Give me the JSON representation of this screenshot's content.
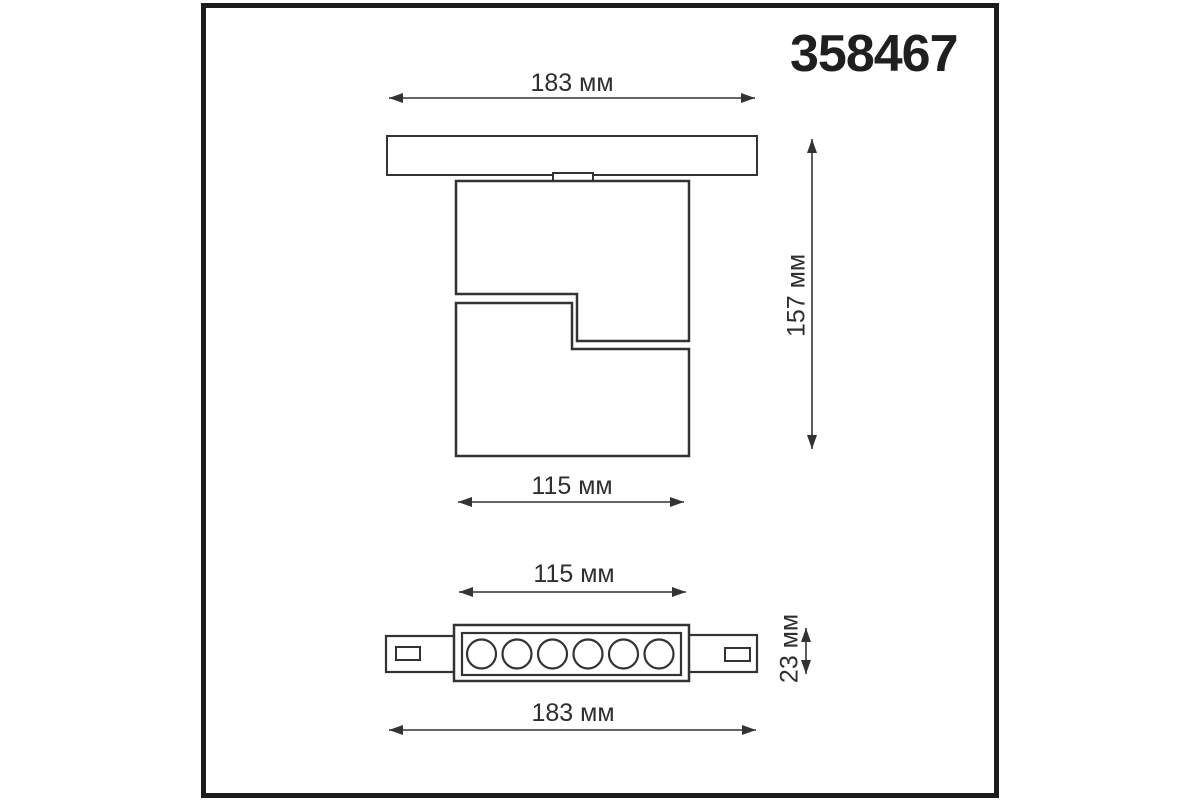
{
  "product": {
    "article": "358467"
  },
  "units": "мм",
  "colors": {
    "line": "#333333",
    "frame": "#1c1c1c",
    "background": "#ffffff"
  },
  "views": {
    "side": {
      "description": "side view of track-mounted spot with track rail, adapter and two offset body blocks",
      "dimensions": {
        "track_width": {
          "label": "183 мм",
          "value_mm": 183
        },
        "height": {
          "label": "157 мм",
          "value_mm": 157
        },
        "body_width": {
          "label": "115 мм",
          "value_mm": 115
        }
      }
    },
    "bottom": {
      "description": "bottom view of linear LED module with two mounting tabs",
      "led_count": 6,
      "dimensions": {
        "body_width": {
          "label": "115 мм",
          "value_mm": 115
        },
        "depth": {
          "label": "23 мм",
          "value_mm": 23
        },
        "overall_length": {
          "label": "183 мм",
          "value_mm": 183
        }
      }
    }
  }
}
